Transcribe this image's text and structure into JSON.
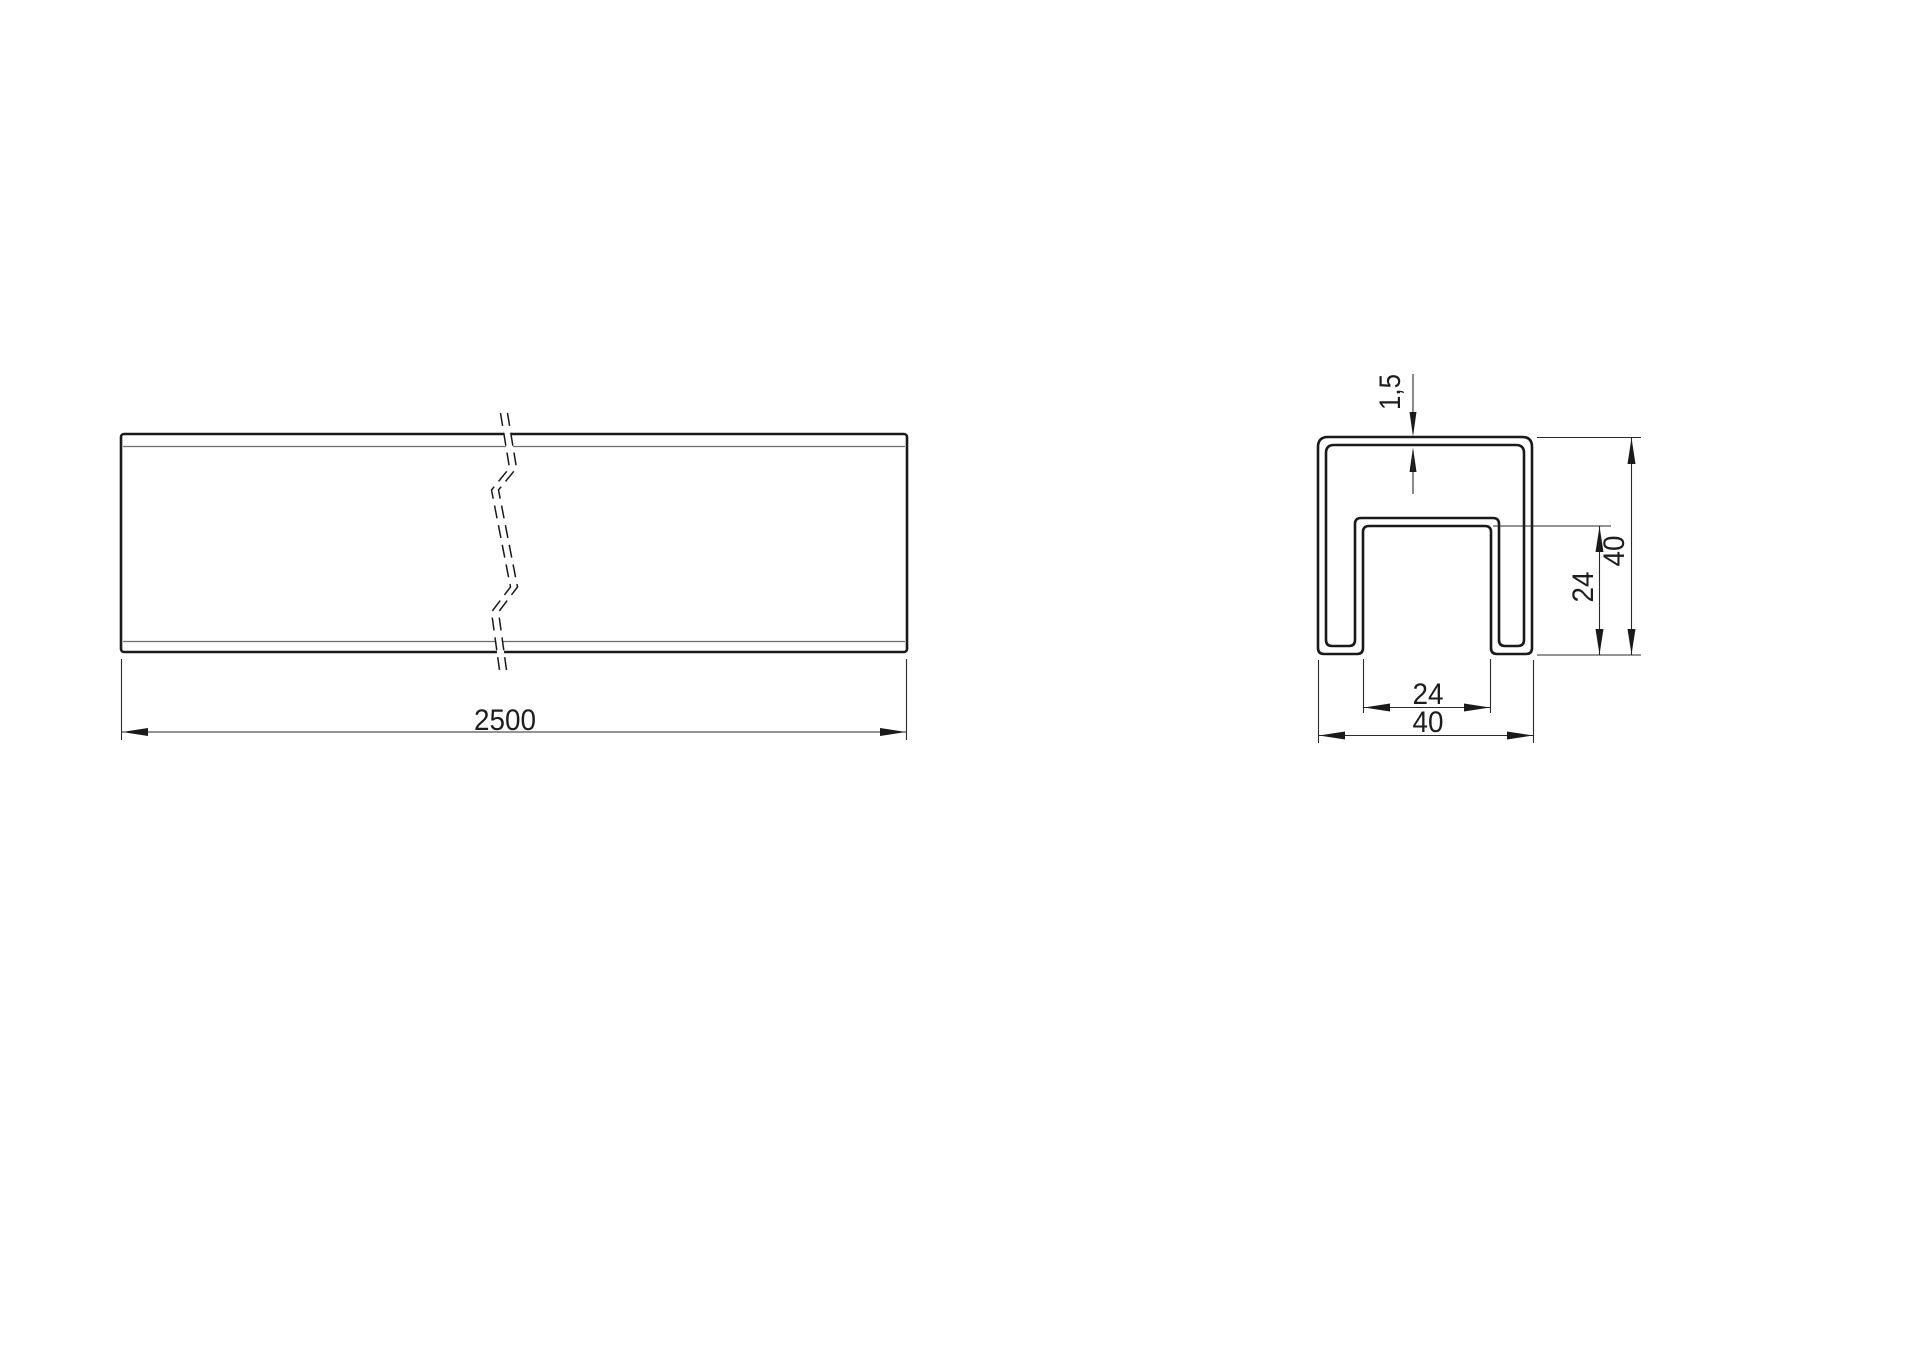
{
  "drawing": {
    "side_view": {
      "length_label": "2500"
    },
    "section_view": {
      "thickness_label": "1,5",
      "slot_depth_label": "24",
      "height_label": "40",
      "slot_width_label": "24",
      "width_label": "40"
    },
    "colors": {
      "line": "#1a1a1a",
      "thin_edge": "#6e6e6e",
      "background": "#ffffff"
    }
  }
}
